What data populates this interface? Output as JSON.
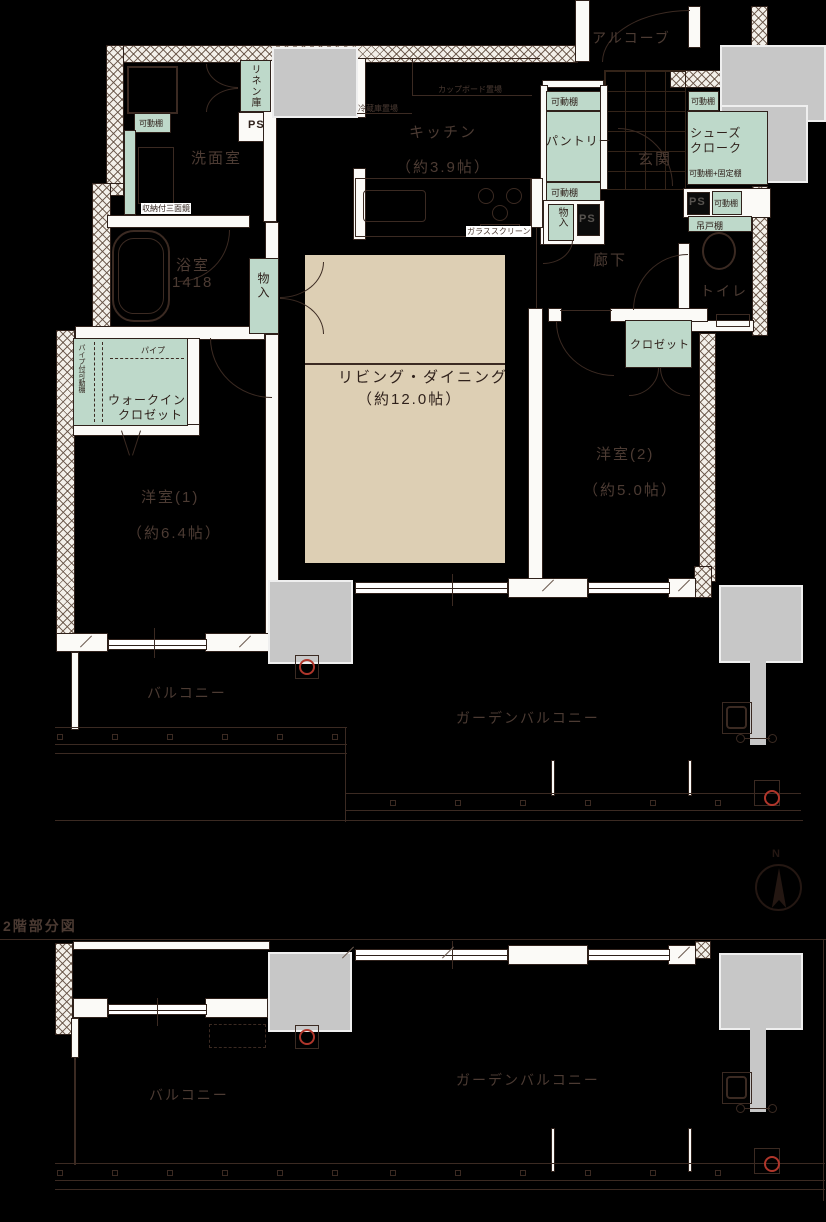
{
  "colors": {
    "mint": "#bed9ca",
    "beige": "#ddcfb4",
    "gray": "#c7c7c7",
    "wall": "#fbfaf7",
    "line": "#3b2a22",
    "label": "#4c3b33",
    "dark": "#2f211b",
    "red": "#b0362b",
    "bg": "#000000"
  },
  "labels": {
    "floor2_caption": "2階部分図",
    "compass_north": "N",
    "alcove": "アルコーブ",
    "linen_closet": "リネン庫",
    "ps": "PS",
    "movable_shelf": "可動棚",
    "movable_fixed_shelf": "可動棚+固定棚",
    "hanging_cupboard": "吊戸棚",
    "washroom": "洗面室",
    "mirror_cabinet": "収納付三面鏡",
    "bathroom": "浴室",
    "bathroom_size": "1418",
    "storage": "物入",
    "kitchen": "キッチン",
    "kitchen_area": "（約3.9帖）",
    "cupboard_space": "カップボード置場",
    "fridge_space": "冷蔵庫置場",
    "glass_screen": "ガラススクリーン",
    "pantry": "パントリー",
    "entrance": "玄関",
    "shoes_cloak_line1": "シューズ",
    "shoes_cloak_line2": "クローク",
    "hallway": "廊下",
    "toilet": "トイレ",
    "closet": "クロゼット",
    "living_dining": "リビング・ダイニング",
    "living_dining_area": "（約12.0帖）",
    "bedroom2": "洋室(2)",
    "bedroom2_area": "（約5.0帖）",
    "bedroom1": "洋室(1)",
    "bedroom1_area": "（約6.4帖）",
    "wic_line1": "ウォークイン",
    "wic_line2": "クロゼット",
    "pipe": "パイプ",
    "pipe_shelf": "パイプ付可動棚",
    "balcony": "バルコニー",
    "garden_balcony": "ガーデンバルコニー"
  }
}
